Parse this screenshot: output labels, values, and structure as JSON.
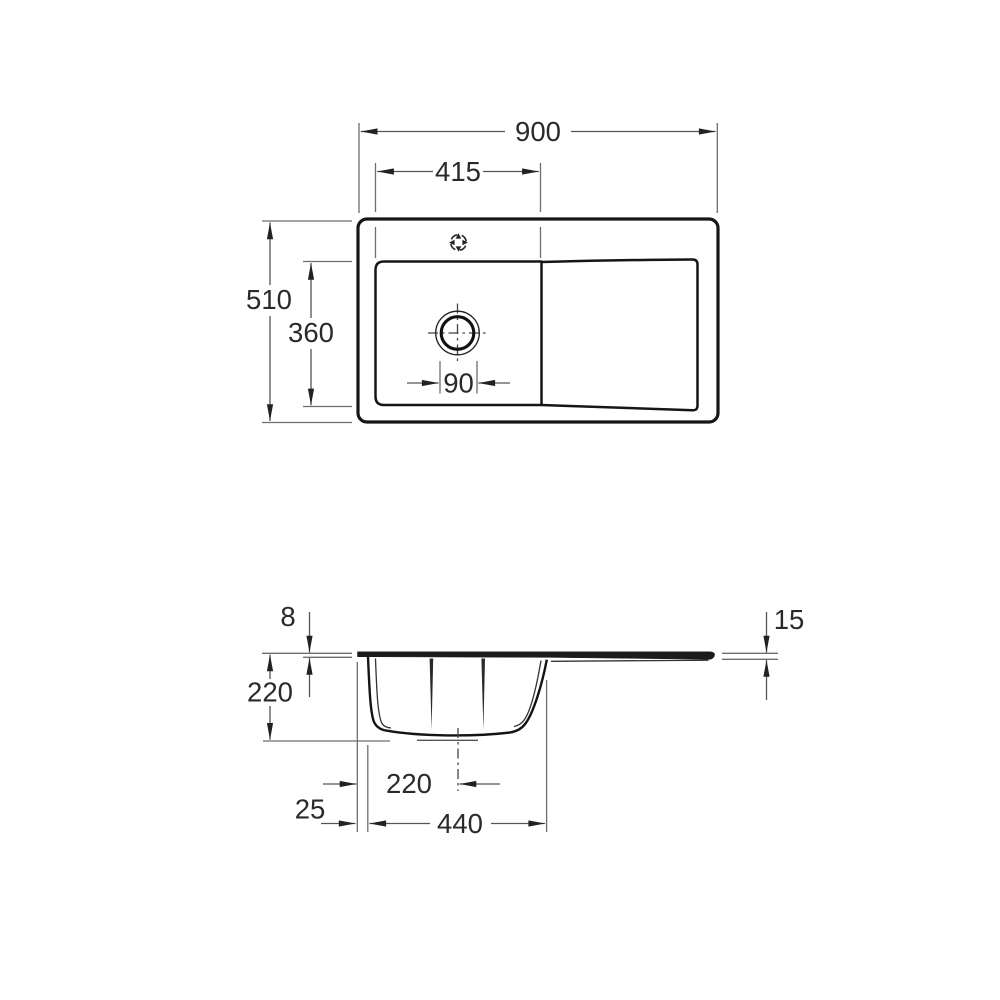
{
  "drawing": {
    "background": "#ffffff",
    "outline_color": "#161616",
    "dimension_line_color": "#6e6e6e",
    "arrow_color": "#222222",
    "text_color": "#2a2a2a",
    "views": {
      "top": {
        "name": "top view",
        "dims": {
          "overall_width": "900",
          "edge_to_divider": "415",
          "overall_depth": "510",
          "bowl_inner_depth": "360",
          "drain_diameter": "90"
        }
      },
      "side": {
        "name": "side section view",
        "dims": {
          "rim_thickness": "8",
          "overall_height": "220",
          "drainboard_edge_thickness": "15",
          "bowl_edge_to_drain_center": "220",
          "edge_to_bowl_offset": "25",
          "bowl_outer_width": "440"
        }
      }
    }
  }
}
